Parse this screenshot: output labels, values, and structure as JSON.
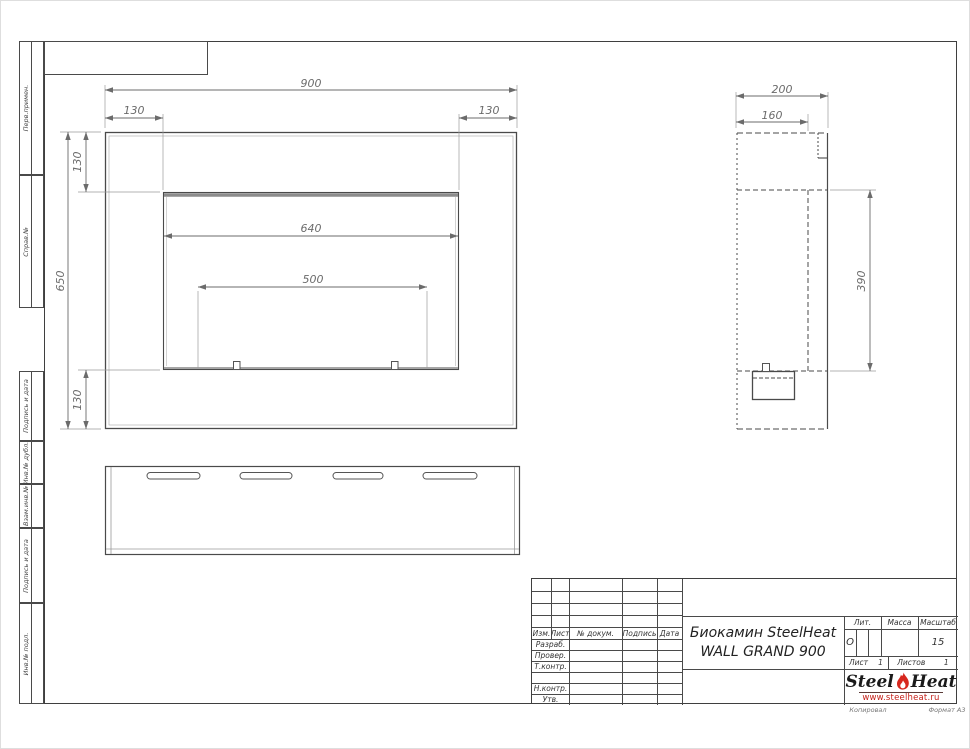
{
  "sheet": {
    "footer_left": "Копировал",
    "footer_right": "Формат А3"
  },
  "margin_labels": {
    "top_group": [
      "Перв.примен.",
      "Справ.№"
    ],
    "bottom_group": [
      "Подпись и дата",
      "Инв.№ дубл.",
      "Взам.инв.№",
      "Подпись и дата",
      "Инв.№ подл."
    ]
  },
  "drawing": {
    "front_view": {
      "overall_width": "900",
      "left_offset": "130",
      "right_offset": "130",
      "overall_height": "650",
      "top_offset": "130",
      "bottom_offset": "130",
      "opening_width": "640",
      "burner_width": "500"
    },
    "side_view": {
      "depth": "200",
      "inner_depth": "160",
      "opening_height": "390"
    }
  },
  "title_block": {
    "header_cols": [
      "Изм.",
      "Лист",
      "№ докум.",
      "Подпись",
      "Дата"
    ],
    "sign_rows": [
      "Разраб.",
      "Провер.",
      "Т.контр.",
      "",
      "Н.контр.",
      "Утв."
    ],
    "doc_title_line1": "Биокамин SteelHeat",
    "doc_title_line2": "WALL GRAND 900",
    "lit_label": "Лит.",
    "lit_value": "О",
    "mass_label": "Масса",
    "scale_label": "Масштаб",
    "scale_value": "15",
    "sheet_label": "Лист",
    "sheet_no": "1",
    "sheets_label": "Листов",
    "sheets_total": "1",
    "logo_steel": "Steel",
    "logo_heat": "Heat",
    "logo_url": "www.steelheat.ru"
  },
  "colors": {
    "line": "#4a4a4a",
    "dim": "#999999",
    "accent_red": "#d7281e"
  }
}
